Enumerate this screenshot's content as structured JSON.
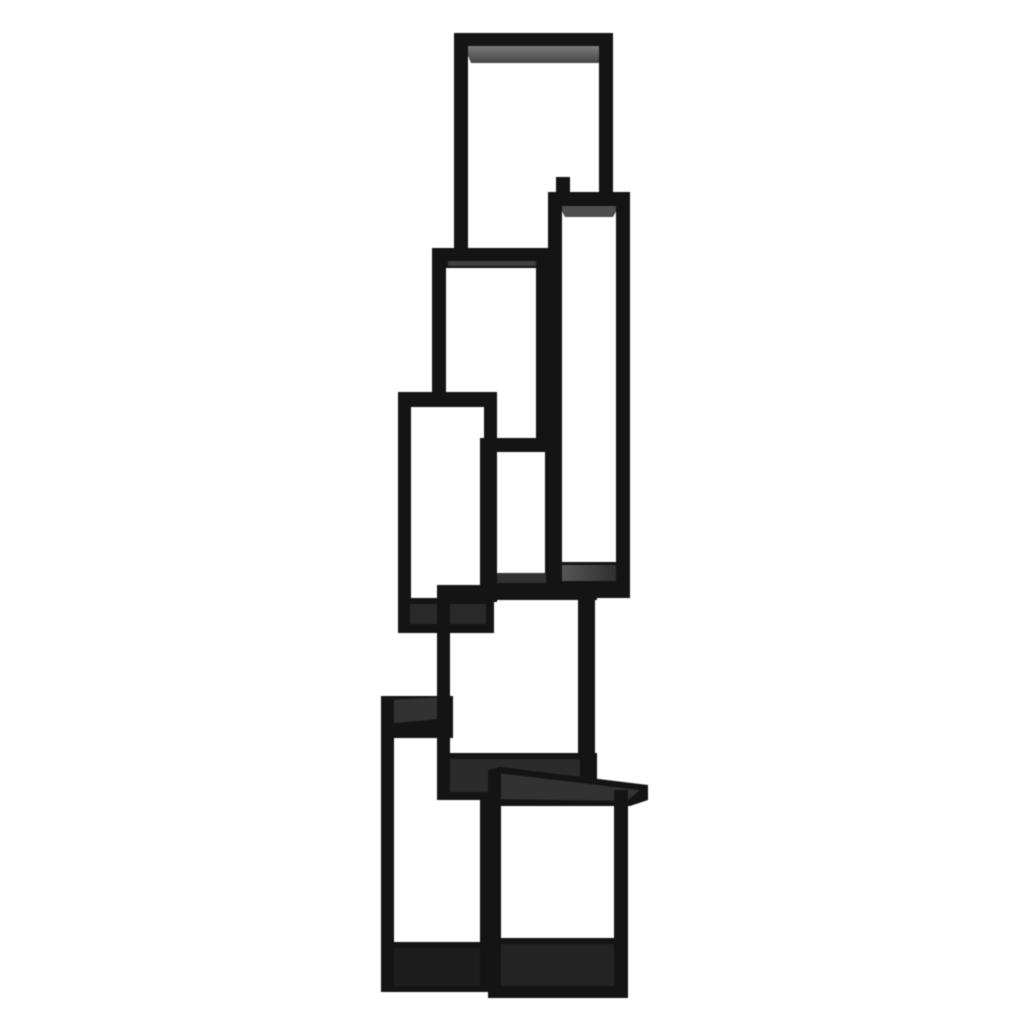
{
  "scene": {
    "type": "studio-product-photo",
    "description": "Tall black modern bookcase / étagère made of eight open rectangular box shelves stacked in a staggered zig-zag tower, photographed on a plain white background.",
    "background_color": "#ffffff",
    "object_color": "#141414"
  },
  "palette": {
    "frame": "#141414",
    "frame_deep": "#0c0c0c",
    "face_light": "#787878",
    "face_mid": "#4e4e4e",
    "face_line": "#3f3f3f",
    "face_charcoal": "#323232",
    "face_shelf": "#2b2b2b",
    "face_dusk": "#2a2a2a",
    "face_dark": "#232323",
    "face_deepdark": "#1d1d1d",
    "background": "#ffffff"
  },
  "artwork": {
    "canvas": {
      "width": 1024,
      "height": 1024
    },
    "shapes": [
      {
        "name": "box-a-top-bar",
        "kind": "rect",
        "x": 456,
        "y": 33,
        "w": 157,
        "h": 14,
        "fill": "frame"
      },
      {
        "name": "box-a-top-inner-face",
        "kind": "poly",
        "points": "464,46 608,46 599,63 471,63",
        "fill": "grad_a"
      },
      {
        "name": "box-a-left-leg",
        "kind": "rect",
        "x": 454,
        "y": 33,
        "w": 14,
        "h": 218,
        "fill": "frame"
      },
      {
        "name": "box-a-right-leg",
        "kind": "rect",
        "x": 599,
        "y": 33,
        "w": 14,
        "h": 160,
        "fill": "frame"
      },
      {
        "name": "box-a-back-leg-stub",
        "kind": "rect",
        "x": 556,
        "y": 177,
        "w": 14,
        "h": 16,
        "fill": "frame"
      },
      {
        "name": "box-b-top-bar",
        "kind": "rect",
        "x": 548,
        "y": 192,
        "w": 82,
        "h": 15,
        "fill": "frame"
      },
      {
        "name": "box-b-top-inner-face",
        "kind": "poly",
        "points": "559,206 619,206 613,217 565,217",
        "fill": "face_mid"
      },
      {
        "name": "box-b-left-wall",
        "kind": "rect",
        "x": 548,
        "y": 192,
        "w": 14,
        "h": 406,
        "fill": "frame"
      },
      {
        "name": "box-b-right-wall",
        "kind": "rect",
        "x": 616,
        "y": 192,
        "w": 14,
        "h": 406,
        "fill": "frame"
      },
      {
        "name": "box-b-bottom-bar",
        "kind": "rect",
        "x": 548,
        "y": 562,
        "w": 82,
        "h": 36,
        "fill": "frame"
      },
      {
        "name": "box-b-bottom-shelf-face",
        "kind": "rect",
        "x": 562,
        "y": 565,
        "w": 54,
        "h": 16,
        "fill": "grad_b"
      },
      {
        "name": "box-c-top-bar",
        "kind": "rect",
        "x": 437,
        "y": 248,
        "w": 112,
        "h": 20,
        "fill": "frame"
      },
      {
        "name": "box-c-top-face-line",
        "kind": "rect",
        "x": 448,
        "y": 261,
        "w": 90,
        "h": 5,
        "fill": "face_line"
      },
      {
        "name": "box-c-left-leg",
        "kind": "rect",
        "x": 432,
        "y": 248,
        "w": 14,
        "h": 150,
        "fill": "frame"
      },
      {
        "name": "box-c-right-leg",
        "kind": "rect",
        "x": 536,
        "y": 248,
        "w": 13,
        "h": 204,
        "fill": "frame"
      },
      {
        "name": "box-c2-top-bar",
        "kind": "rect",
        "x": 480,
        "y": 438,
        "w": 78,
        "h": 14,
        "fill": "frame"
      },
      {
        "name": "box-c2-left-wall",
        "kind": "rect",
        "x": 480,
        "y": 438,
        "w": 13,
        "h": 152,
        "fill": "frame"
      },
      {
        "name": "box-c2-right-wall",
        "kind": "rect",
        "x": 545,
        "y": 438,
        "w": 13,
        "h": 152,
        "fill": "frame"
      },
      {
        "name": "box-c2-bottom-face",
        "kind": "rect",
        "x": 492,
        "y": 573,
        "w": 54,
        "h": 12,
        "fill": "face_charcoal"
      },
      {
        "name": "box-c2-bottom-bar",
        "kind": "rect",
        "x": 480,
        "y": 583,
        "w": 78,
        "h": 9,
        "fill": "frame"
      },
      {
        "name": "box-d-top-bar",
        "kind": "rect",
        "x": 398,
        "y": 392,
        "w": 99,
        "h": 15,
        "fill": "frame"
      },
      {
        "name": "box-d-left-wall",
        "kind": "rect",
        "x": 398,
        "y": 392,
        "w": 13,
        "h": 241,
        "fill": "frame"
      },
      {
        "name": "box-d-right-wall",
        "kind": "rect",
        "x": 484,
        "y": 392,
        "w": 13,
        "h": 210,
        "fill": "frame"
      },
      {
        "name": "box-d-bottom-bar",
        "kind": "rect",
        "x": 398,
        "y": 598,
        "w": 96,
        "h": 35,
        "fill": "frame"
      },
      {
        "name": "box-d-bottom-face",
        "kind": "rect",
        "x": 410,
        "y": 604,
        "w": 76,
        "h": 20,
        "fill": "face_dusk"
      },
      {
        "name": "box-f-top-bar",
        "kind": "rect",
        "x": 381,
        "y": 696,
        "w": 72,
        "h": 42,
        "fill": "frame"
      },
      {
        "name": "box-f-top-face",
        "kind": "poly",
        "points": "384,700 450,697 450,718 384,724",
        "fill": "face_charcoal"
      },
      {
        "name": "box-f-left-wall",
        "kind": "rect",
        "x": 381,
        "y": 696,
        "w": 13,
        "h": 294,
        "fill": "frame"
      },
      {
        "name": "box-f-right-wall",
        "kind": "rect",
        "x": 480,
        "y": 757,
        "w": 14,
        "h": 233,
        "fill": "frame"
      },
      {
        "name": "box-f-bottom-bar",
        "kind": "rect",
        "x": 381,
        "y": 942,
        "w": 113,
        "h": 50,
        "fill": "frame"
      },
      {
        "name": "box-f-bottom-face",
        "kind": "rect",
        "x": 394,
        "y": 948,
        "w": 86,
        "h": 38,
        "fill": "face_deepdark"
      },
      {
        "name": "box-e-top-bar",
        "kind": "rect",
        "x": 437,
        "y": 585,
        "w": 160,
        "h": 15,
        "fill": "frame"
      },
      {
        "name": "box-e-left-wall",
        "kind": "rect",
        "x": 437,
        "y": 585,
        "w": 13,
        "h": 212,
        "fill": "frame"
      },
      {
        "name": "box-e-right-wall",
        "kind": "rect",
        "x": 578,
        "y": 585,
        "w": 17,
        "h": 212,
        "fill": "frame"
      },
      {
        "name": "box-e-bottom-bar",
        "kind": "rect",
        "x": 437,
        "y": 753,
        "w": 160,
        "h": 47,
        "fill": "frame"
      },
      {
        "name": "box-e-bottom-shelf-face",
        "kind": "rect",
        "x": 450,
        "y": 759,
        "w": 130,
        "h": 33,
        "fill": "face_shelf"
      },
      {
        "name": "box-g-top-bar",
        "kind": "poly",
        "points": "488,770 500,767 648,785 648,800 630,806 488,806",
        "fill": "frame"
      },
      {
        "name": "box-g-top-face",
        "kind": "poly",
        "points": "497,773 640,790 627,801 492,799",
        "fill": "face_charcoal"
      },
      {
        "name": "box-g-left-wall",
        "kind": "rect",
        "x": 488,
        "y": 770,
        "w": 13,
        "h": 228,
        "fill": "frame"
      },
      {
        "name": "box-g-right-wall",
        "kind": "rect",
        "x": 614,
        "y": 790,
        "w": 14,
        "h": 208,
        "fill": "frame"
      },
      {
        "name": "box-g-bottom-bar",
        "kind": "rect",
        "x": 488,
        "y": 938,
        "w": 140,
        "h": 60,
        "fill": "frame"
      },
      {
        "name": "box-g-bottom-face",
        "kind": "rect",
        "x": 501,
        "y": 944,
        "w": 113,
        "h": 42,
        "fill": "face_dark"
      }
    ]
  }
}
